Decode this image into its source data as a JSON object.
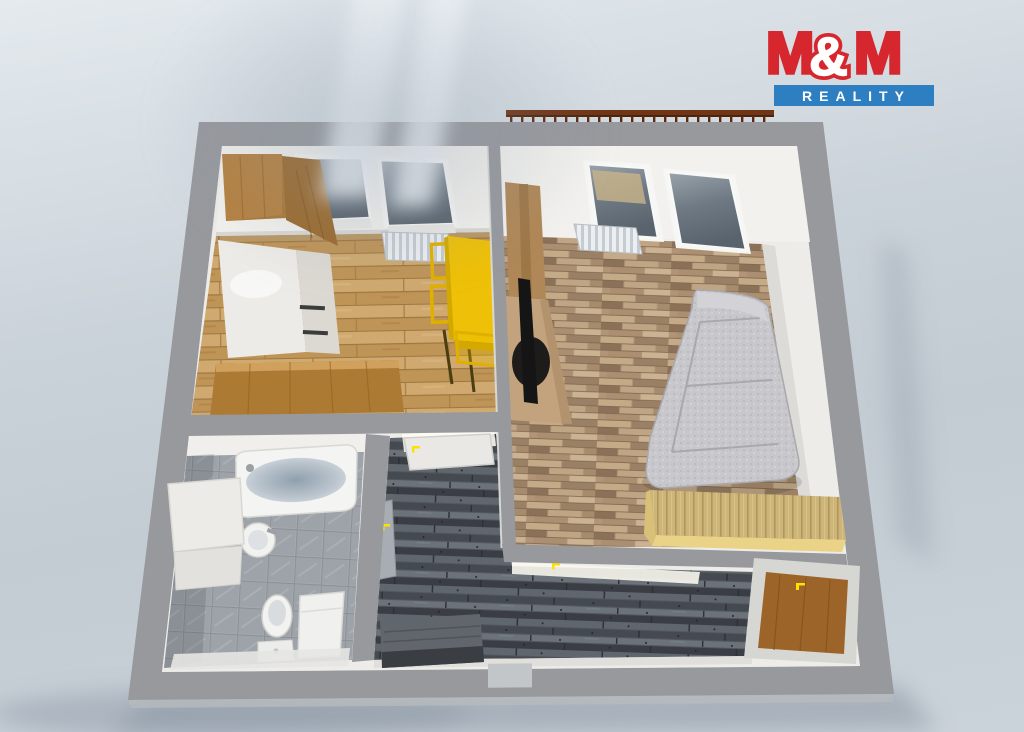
{
  "logo": {
    "m1": "M",
    "amp": "&",
    "m2": "M",
    "reality": "REALITY"
  },
  "colors": {
    "background": "#cbd3da",
    "background_light": "#e4eaee",
    "brand_red": "#d7272e",
    "brand_blue": "#2d7fc1",
    "wall_gray": "#97999d",
    "interior_white": "#edece8",
    "floor_oak": "#c9a268",
    "floor_parquet": "#b29477",
    "floor_dark": "#53575d",
    "tile_gray": "#a4a9ae",
    "accent_yellow": "#eec007",
    "wood_cabinet": "#b5813f",
    "wood_counter": "#ad7a33",
    "sofa_gray": "#c7c7cc",
    "chest_wood": "#cdb478",
    "door_brown": "#9c6428",
    "handle_yellow": "#ffe000",
    "tv_black": "#151515",
    "shadow": "#8c97a3",
    "glass_dark": "#5f6a74",
    "radiator_white": "#eceff1",
    "railing_brown": "#6f3514"
  }
}
